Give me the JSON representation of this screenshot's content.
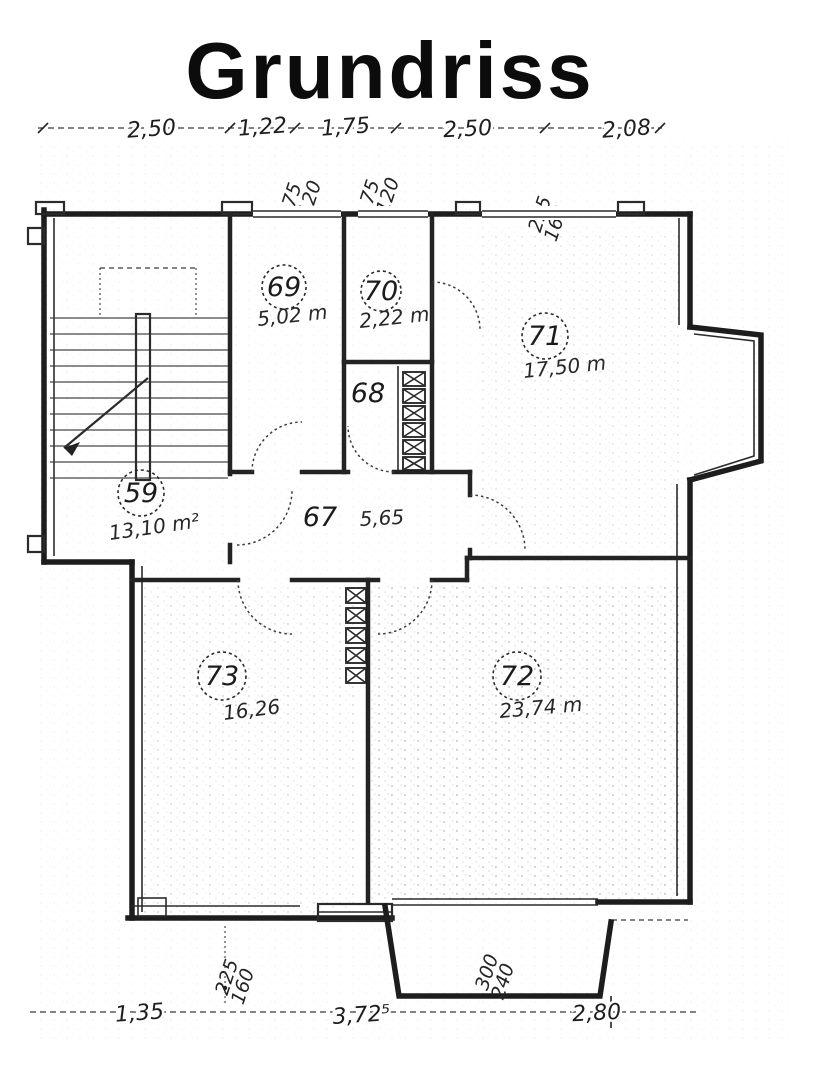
{
  "title": "Grundriss",
  "dimensions": {
    "top": [
      "2,50",
      "1,22",
      "1,75",
      "2,50",
      "2,08"
    ],
    "bottom": [
      "1,35",
      "3,72⁵",
      "2,80"
    ]
  },
  "window_tags": {
    "top_69": {
      "w": "75",
      "h": "120"
    },
    "top_70": {
      "w": "75",
      "h": "120"
    },
    "top_71": {
      "w": "225",
      "h": "160"
    },
    "bottom_73": {
      "w": "225",
      "h": "160"
    },
    "bottom_72": {
      "w": "300",
      "h": "240"
    }
  },
  "rooms": {
    "r59": {
      "number": "59",
      "area": "13,10 m²"
    },
    "r67": {
      "number": "67",
      "area": "5,65"
    },
    "r68": {
      "number": "68"
    },
    "r69": {
      "number": "69",
      "area": "5,02 m"
    },
    "r70": {
      "number": "70",
      "area": "2,22 m"
    },
    "r71": {
      "number": "71",
      "area": "17,50 m"
    },
    "r72": {
      "number": "72",
      "area": "23,74 m"
    },
    "r73": {
      "number": "73",
      "area": "16,26"
    }
  },
  "colors": {
    "ink": "#1d1d1d",
    "paper": "#ffffff"
  }
}
